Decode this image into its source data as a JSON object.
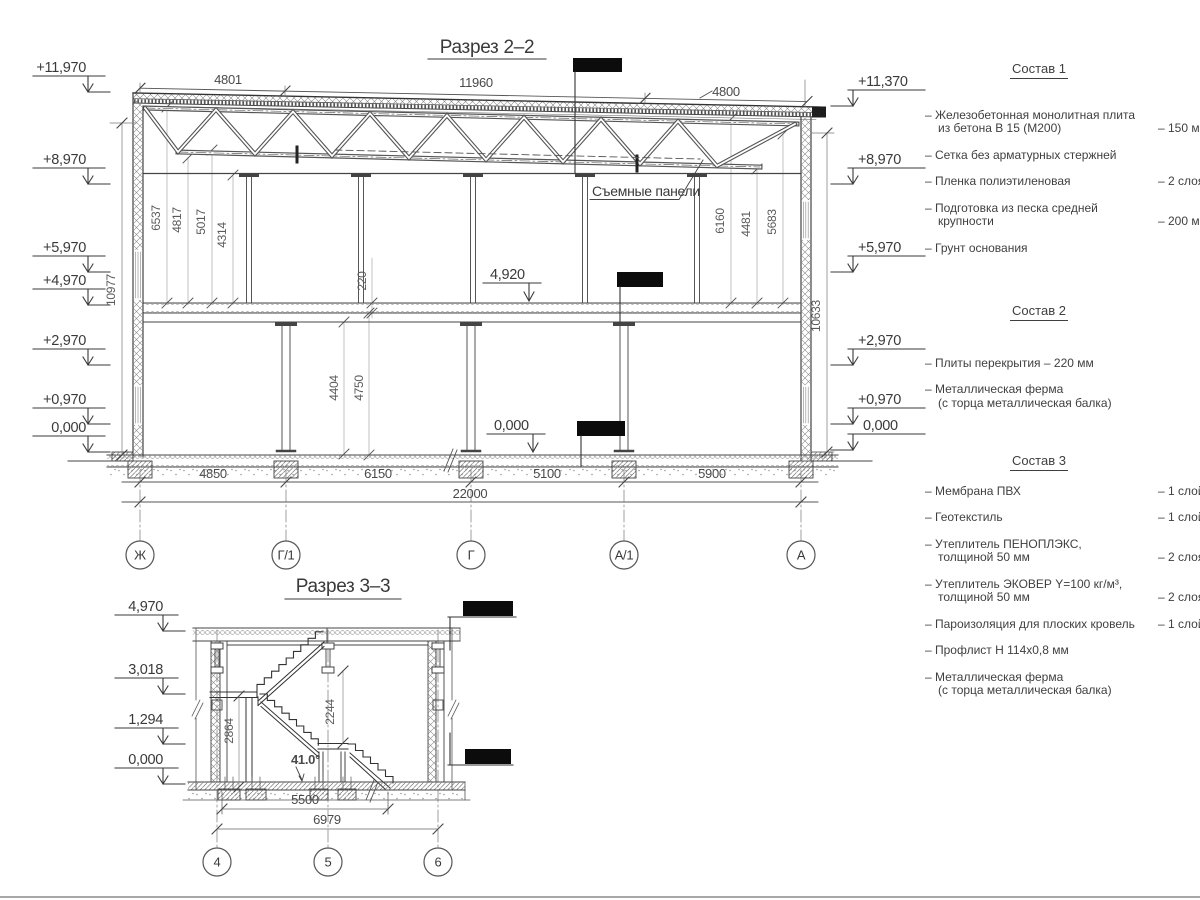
{
  "s2": {
    "title": "Разрез 2–2",
    "top_dims": [
      "4801",
      "11960",
      "4800"
    ],
    "elev_left": [
      "+11,970",
      "+8,970",
      "+5,970",
      "+4,970",
      "+2,970",
      "+0,970",
      "0,000"
    ],
    "elev_right": [
      "+11,370",
      "+8,970",
      "+5,970",
      "+2,970",
      "+0,970",
      "0,000"
    ],
    "level_floor2": "4,920",
    "level_floor1": "0,000",
    "callout_panels": "Съемные панели",
    "vdims_left": [
      "6537",
      "4817",
      "5017",
      "4314"
    ],
    "vdims_right": [
      "6160",
      "4481",
      "5683"
    ],
    "slab_thickness": "220",
    "vdims_floor1": [
      "4404",
      "4750"
    ],
    "height_left": "10977",
    "height_right": "10633",
    "span_dims": [
      "4850",
      "6150",
      "5100",
      "5900"
    ],
    "span_total": "22000",
    "grid_axes": [
      "Ж",
      "Г/1",
      "Г",
      "А/1",
      "А"
    ]
  },
  "s3": {
    "title": "Разрез 3–3",
    "elev": [
      "4,970",
      "3,018",
      "1,294",
      "0,000"
    ],
    "vdims": [
      "2864",
      "2244"
    ],
    "angle": "41.0°",
    "span_dims": [
      "5500",
      "6979"
    ],
    "grid_axes": [
      "4",
      "5",
      "6"
    ]
  },
  "legend": {
    "comp1": {
      "title": "Состав 1",
      "items": [
        {
          "name": "– Железобетонная  монолитная плита\nиз бетона В 15 (М200)",
          "value": "– 150 мм"
        },
        {
          "name": "– Сетка без арматурных стержней",
          "value": ""
        },
        {
          "name": "– Пленка полиэтиленовая",
          "value": "–  2 слоя"
        },
        {
          "name": "– Подготовка из песка средней\nкрупности",
          "value": "– 200 мм"
        },
        {
          "name": "– Грунт основания",
          "value": ""
        }
      ]
    },
    "comp2": {
      "title": "Состав 2",
      "items": [
        {
          "name": "– Плиты перекрытия – 220 мм",
          "value": ""
        },
        {
          "name": "– Металлическая ферма\n(с торца металлическая балка)",
          "value": ""
        }
      ]
    },
    "comp3": {
      "title": "Состав 3",
      "items": [
        {
          "name": "– Мембрана ПВХ",
          "value": "– 1 слой"
        },
        {
          "name": "– Геотекстиль",
          "value": "– 1 слой"
        },
        {
          "name": "– Утеплитель ПЕНОПЛЭКС,\nтолщиной 50 мм",
          "value": "– 2 слоя"
        },
        {
          "name": "– Утеплитель ЭКОВЕР Y=100 кг/м³,\nтолщиной 50 мм",
          "value": "– 2 слоя"
        },
        {
          "name": "– Пароизоляция для плоских кровель",
          "value": "– 1 слой"
        },
        {
          "name": "– Профлист Н 114х0,8 мм",
          "value": ""
        },
        {
          "name": "– Металлическая ферма\n(с торца металлическая балка)",
          "value": ""
        }
      ]
    }
  }
}
